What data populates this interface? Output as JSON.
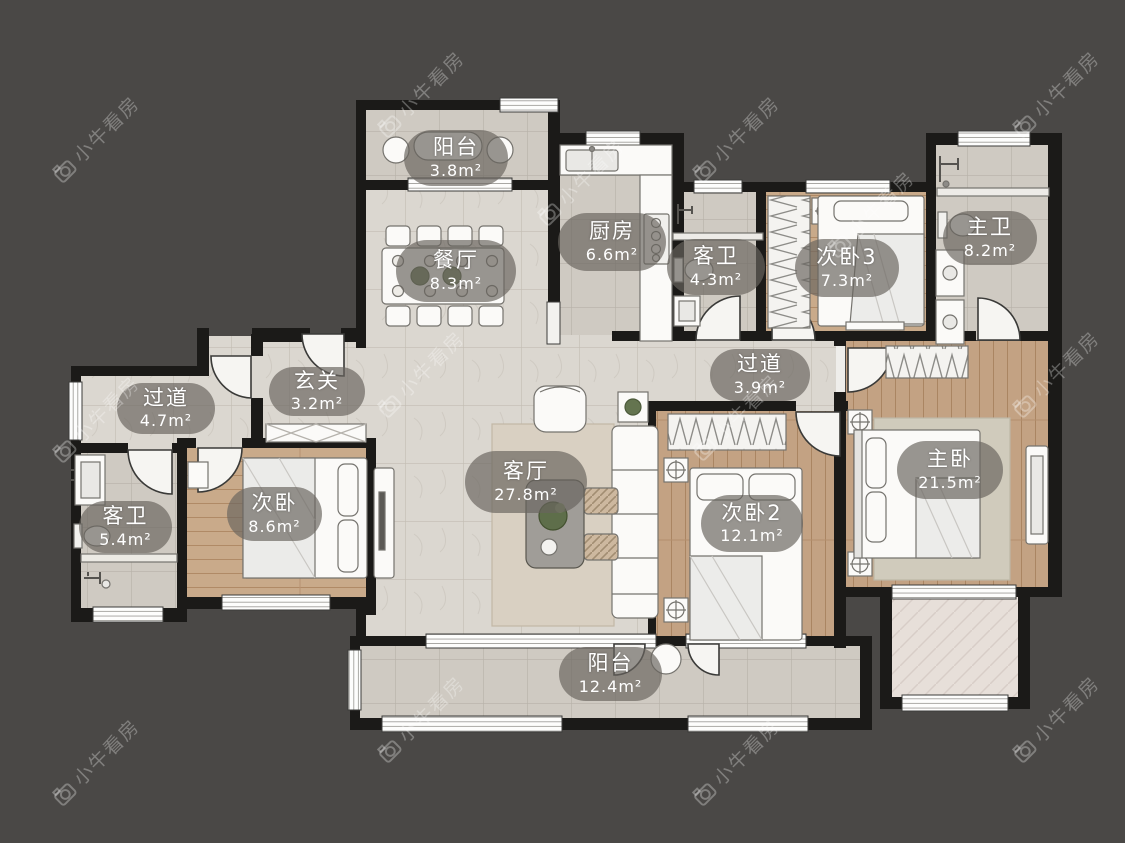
{
  "watermark": {
    "text": "小牛看房"
  },
  "palette": {
    "background": "#4a4846",
    "wall": "#1b1a18",
    "tile_floor": "#cfcac2",
    "marble_floor": "#dbd7d0",
    "wood_floor": "#c9aa8a",
    "terrace_floor": "#e7dfd9",
    "label_pill": "rgba(104,100,95,0.68)",
    "label_text": "#ffffff"
  },
  "rooms": [
    {
      "id": "balcony-top",
      "name": "阳台",
      "area": "3.8m²"
    },
    {
      "id": "dining-room",
      "name": "餐厅",
      "area": "8.3m²"
    },
    {
      "id": "kitchen",
      "name": "厨房",
      "area": "6.6m²"
    },
    {
      "id": "guest-bath-top",
      "name": "客卫",
      "area": "4.3m²"
    },
    {
      "id": "bedroom-3",
      "name": "次卧3",
      "area": "7.3m²"
    },
    {
      "id": "master-bath",
      "name": "主卫",
      "area": "8.2m²"
    },
    {
      "id": "hallway-right",
      "name": "过道",
      "area": "3.9m²"
    },
    {
      "id": "entry-foyer",
      "name": "玄关",
      "area": "3.2m²"
    },
    {
      "id": "hallway-left",
      "name": "过道",
      "area": "4.7m²"
    },
    {
      "id": "guest-bath-left",
      "name": "客卫",
      "area": "5.4m²"
    },
    {
      "id": "bedroom-side",
      "name": "次卧",
      "area": "8.6m²"
    },
    {
      "id": "living-room",
      "name": "客厅",
      "area": "27.8m²"
    },
    {
      "id": "bedroom-2",
      "name": "次卧2",
      "area": "12.1m²"
    },
    {
      "id": "master-bedroom",
      "name": "主卧",
      "area": "21.5m²"
    },
    {
      "id": "balcony-bottom",
      "name": "阳台",
      "area": "12.4m²"
    }
  ]
}
